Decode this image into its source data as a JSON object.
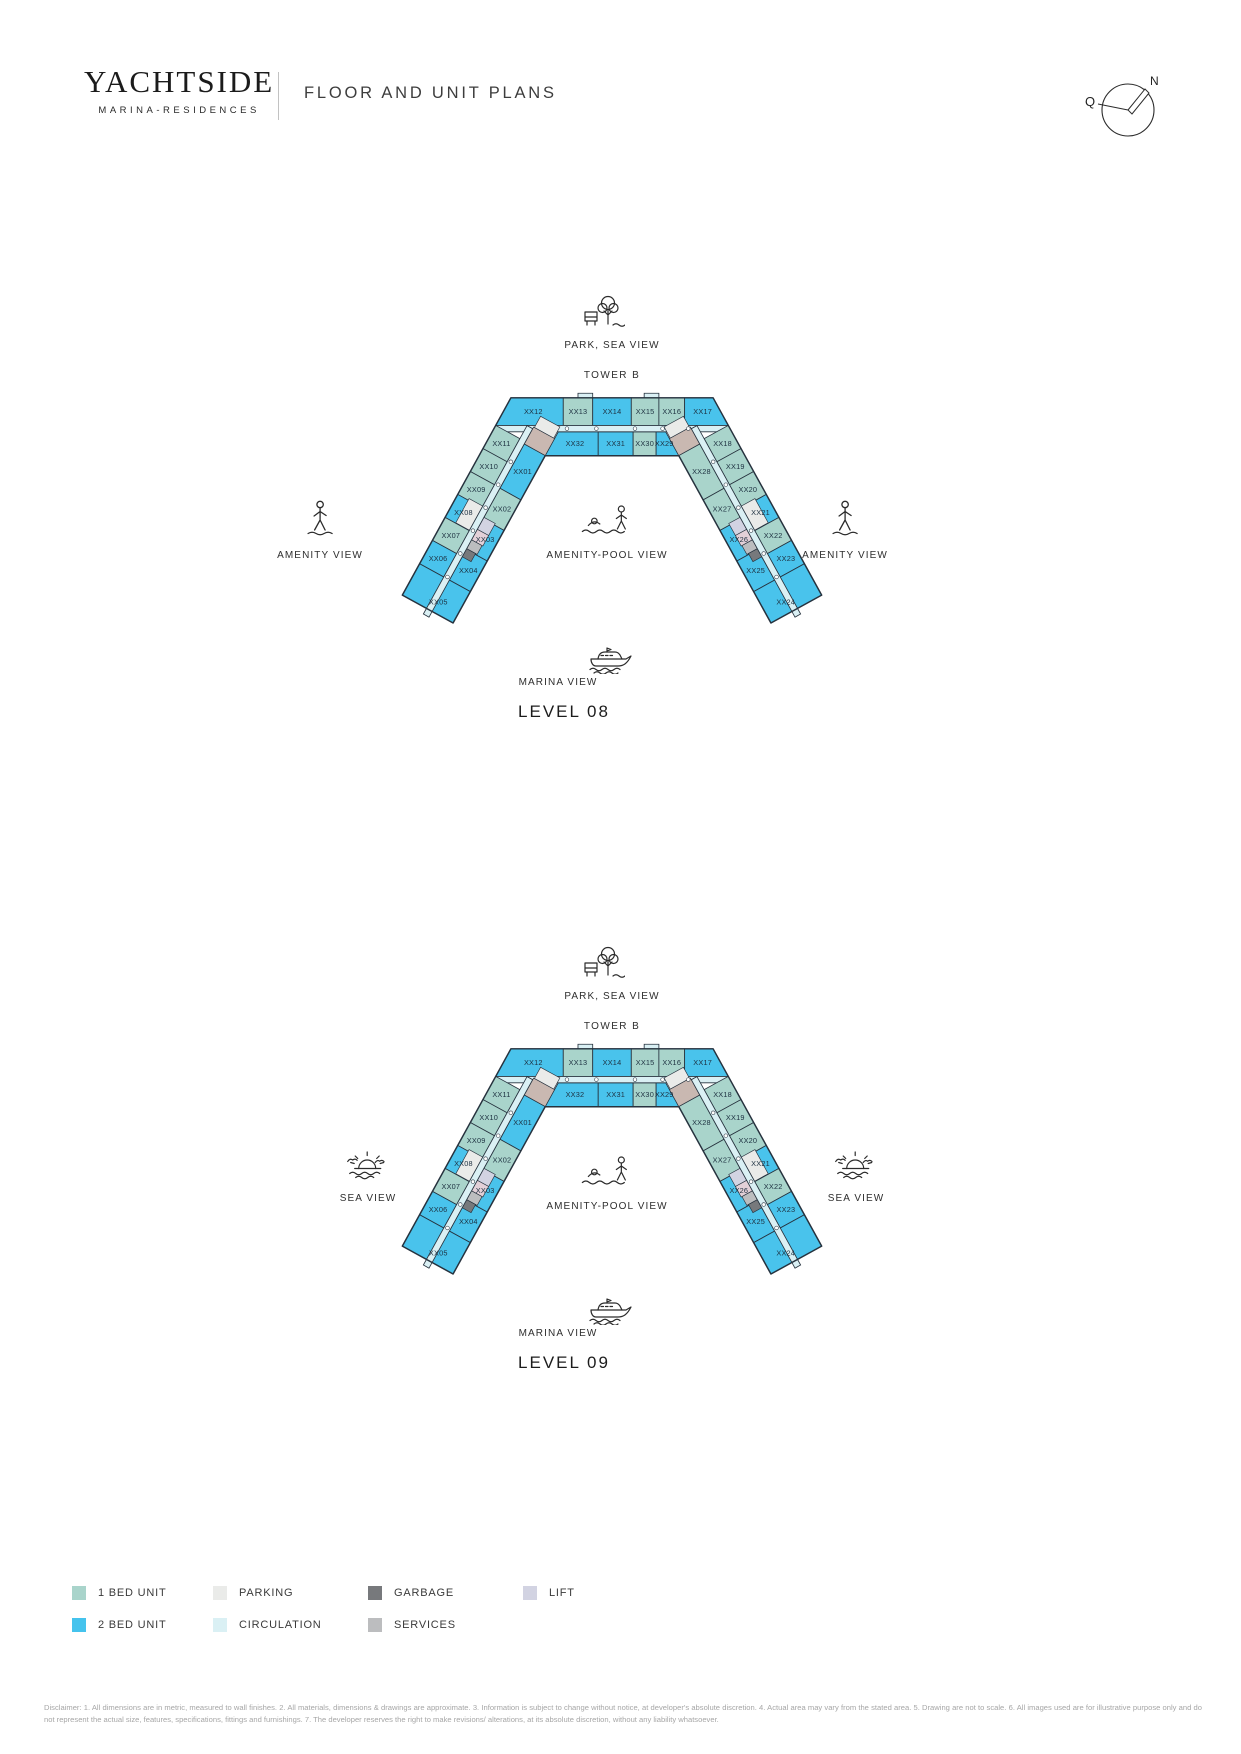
{
  "header": {
    "brand": "YACHTSIDE",
    "brand_sub": "MARINA-RESIDENCES",
    "title": "FLOOR AND UNIT PLANS"
  },
  "compass": {
    "north_label": "N",
    "qibla_label": "Q"
  },
  "palette": {
    "one_bed": "#a9d4cb",
    "two_bed": "#49c3ec",
    "parking": "#eaebe9",
    "circulation": "#daf0f4",
    "garbage": "#77797c",
    "services": "#bcbdbf",
    "lift": "#d2d3e2",
    "lobby": "#e3d0d8",
    "core": "#c9b8b1",
    "outline": "#26323e",
    "label": "#1d3040"
  },
  "plans": [
    {
      "level_label": "LEVEL 08",
      "tower_label": "TOWER B",
      "top_view_label": "PARK, SEA VIEW",
      "left_view_label": "AMENITY VIEW",
      "right_view_label": "AMENITY VIEW",
      "center_view_label": "AMENITY-POOL VIEW",
      "bottom_view_label": "MARINA VIEW",
      "top_icon": "park-icon",
      "left_icon": "amenity-person-icon",
      "right_icon": "amenity-person-icon",
      "center_icon": "pool-icon",
      "bottom_icon": "yacht-icon"
    },
    {
      "level_label": "LEVEL 09",
      "tower_label": "TOWER B",
      "top_view_label": "PARK, SEA VIEW",
      "left_view_label": "SEA VIEW",
      "right_view_label": "SEA VIEW",
      "center_view_label": "AMENITY-POOL VIEW",
      "bottom_view_label": "MARINA VIEW",
      "top_icon": "park-icon",
      "left_icon": "sunset-icon",
      "right_icon": "sunset-icon",
      "center_icon": "pool-icon",
      "bottom_icon": "yacht-icon"
    }
  ],
  "units": {
    "top_outer": [
      {
        "label": "XX12",
        "type": "2bed"
      },
      {
        "label": "XX13",
        "type": "1bed"
      },
      {
        "label": "XX14",
        "type": "2bed"
      },
      {
        "label": "XX15",
        "type": "1bed"
      },
      {
        "label": "XX16",
        "type": "1bed"
      },
      {
        "label": "XX17",
        "type": "2bed"
      }
    ],
    "top_inner": [
      {
        "label": "XX32",
        "type": "2bed"
      },
      {
        "label": "XX31",
        "type": "2bed"
      },
      {
        "label": "XX30",
        "type": "1bed"
      },
      {
        "label": "XX29",
        "type": "2bed"
      }
    ],
    "left_outer": [
      {
        "label": "XX11",
        "type": "1bed"
      },
      {
        "label": "XX10",
        "type": "1bed"
      },
      {
        "label": "XX09",
        "type": "1bed"
      },
      {
        "label": "XX08",
        "type": "2bed"
      },
      {
        "label": "XX07",
        "type": "1bed"
      },
      {
        "label": "XX06",
        "type": "2bed"
      }
    ],
    "left_tip": {
      "label": "XX05",
      "type": "2bed"
    },
    "left_inner": [
      {
        "label": "XX01",
        "type": "2bed"
      },
      {
        "label": "XX02",
        "type": "1bed"
      },
      {
        "label": "XX03",
        "type": "2bed"
      },
      {
        "label": "XX04",
        "type": "2bed"
      }
    ],
    "right_outer": [
      {
        "label": "XX18",
        "type": "1bed"
      },
      {
        "label": "XX19",
        "type": "1bed"
      },
      {
        "label": "XX20",
        "type": "1bed"
      },
      {
        "label": "XX21",
        "type": "2bed"
      },
      {
        "label": "XX22",
        "type": "1bed"
      },
      {
        "label": "XX23",
        "type": "2bed"
      }
    ],
    "right_tip": {
      "label": "XX24",
      "type": "2bed"
    },
    "right_inner": [
      {
        "label": "XX28",
        "type": "1bed"
      },
      {
        "label": "XX27",
        "type": "1bed"
      },
      {
        "label": "XX26",
        "type": "2bed"
      },
      {
        "label": "XX25",
        "type": "2bed"
      }
    ]
  },
  "legend": [
    {
      "label": "1 BED UNIT",
      "color": "#a9d4cb"
    },
    {
      "label": "2 BED UNIT",
      "color": "#45c3ed"
    },
    {
      "label": "PARKING",
      "color": "#eaebe9"
    },
    {
      "label": "CIRCULATION",
      "color": "#daf0f4"
    },
    {
      "label": "GARBAGE",
      "color": "#77797c"
    },
    {
      "label": "SERVICES",
      "color": "#bcbdbf"
    },
    {
      "label": "LIFT",
      "color": "#d2d3e2"
    }
  ],
  "disclaimer": "Disclaimer: 1. All dimensions are in metric, measured to wall finishes. 2. All materials, dimensions & drawings are approximate. 3. Information is subject to change without notice, at developer's absolute discretion. 4. Actual area may vary from the stated area. 5. Drawing are not to scale. 6. All images used are for illustrative purpose only and do not represent the actual size, features, specifications, fittings and furnishings. 7. The developer reserves the right to make revisions/ alterations, at its absolute discretion, without any liability whatsoever."
}
